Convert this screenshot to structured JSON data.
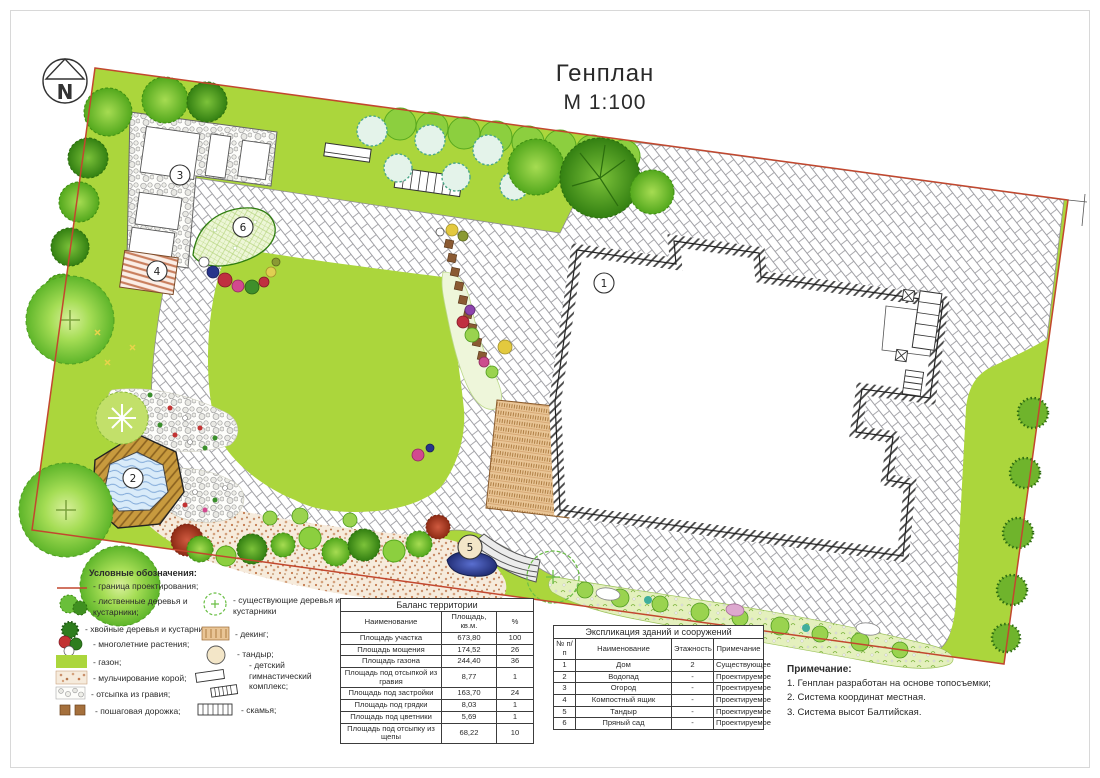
{
  "title": {
    "line1": "Генплан",
    "line2": "М 1:100"
  },
  "north_arrow": {
    "label": "N"
  },
  "legend": {
    "header": "Условные обозначения:",
    "left": [
      {
        "icon": "boundary-line",
        "label": "- граница проектирования;"
      },
      {
        "icon": "deciduous-trees",
        "label": "- лиственные деревья и кустарники;"
      },
      {
        "icon": "conifer-trees",
        "label": "- хвойные деревья и кустарники;"
      },
      {
        "icon": "perennials",
        "label": "- многолетние растения;"
      },
      {
        "icon": "lawn",
        "label": "- газон;"
      },
      {
        "icon": "bark-mulch",
        "label": "- мульчирование корой;"
      },
      {
        "icon": "gravel",
        "label": "- отсыпка из гравия;"
      },
      {
        "icon": "stepping-path",
        "label": "- пошаговая дорожка;"
      }
    ],
    "right": [
      {
        "icon": "existing-trees",
        "label": "- существующие деревья и кустарники"
      },
      {
        "icon": "decking",
        "label": "- декинг;"
      },
      {
        "icon": "tandoor",
        "label": "- тандыр;"
      },
      {
        "icon": "gym-complex",
        "label": "- детский гимнастический комплекс;"
      },
      {
        "icon": "bench",
        "label": "- скамья;"
      }
    ]
  },
  "balance_table": {
    "title": "Баланс территории",
    "headers": [
      "Наименование",
      "Площадь, кв.м.",
      "%"
    ],
    "rows": [
      [
        "Площадь участка",
        "673,80",
        "100"
      ],
      [
        "Площадь мощения",
        "174,52",
        "26"
      ],
      [
        "Площадь газона",
        "244,40",
        "36"
      ],
      [
        "Площадь под отсыпкой из гравия",
        "8,77",
        "1"
      ],
      [
        "Площадь под застройки",
        "163,70",
        "24"
      ],
      [
        "Площадь под грядки",
        "8,03",
        "1"
      ],
      [
        "Площадь под цветники",
        "5,69",
        "1"
      ],
      [
        "Площадь под отсыпку из щепы",
        "68,22",
        "10"
      ]
    ]
  },
  "explication_table": {
    "title": "Экспликация зданий и сооружений",
    "headers": [
      "№ п/п",
      "Наименование",
      "Этажность",
      "Примечание"
    ],
    "rows": [
      [
        "1",
        "Дом",
        "2",
        "Существующее"
      ],
      [
        "2",
        "Водопад",
        "-",
        "Проектируемое"
      ],
      [
        "3",
        "Огород",
        "-",
        "Проектируемое"
      ],
      [
        "4",
        "Компостный ящик",
        "-",
        "Проектируемое"
      ],
      [
        "5",
        "Тандыр",
        "-",
        "Проектируемое"
      ],
      [
        "6",
        "Пряный сад",
        "-",
        "Проектируемое"
      ]
    ]
  },
  "notes": {
    "header": "Примечание:",
    "items": [
      "1. Генплан разработан на основе топосъемки;",
      "2. Система координат местная.",
      "3. Система высот Балтийская."
    ]
  },
  "plan_markers": {
    "house": "1",
    "waterfall": "2",
    "garden": "3",
    "compost": "4",
    "tandoor": "5",
    "spice_garden": "6"
  },
  "colors": {
    "lawn": "#abd63c",
    "boundary": "#c2472e",
    "water": "#d9ebf9",
    "decking": "#e9c596",
    "paving_line": "#a0a0a5"
  }
}
